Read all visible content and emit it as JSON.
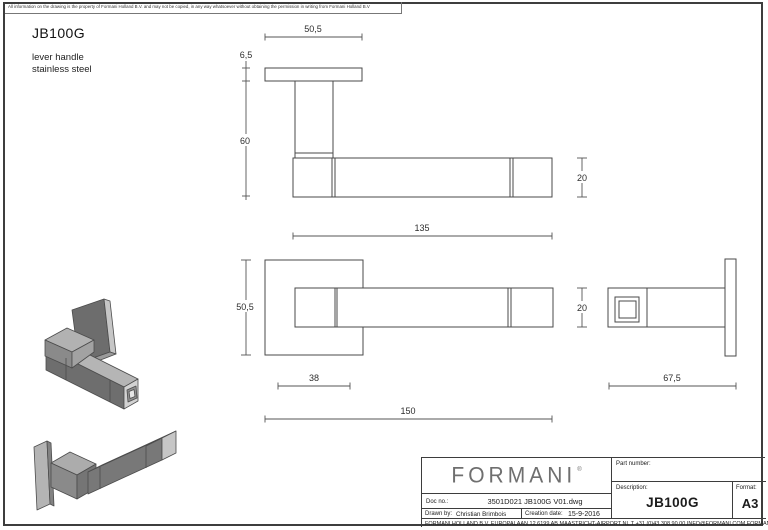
{
  "page": {
    "disclaimer": "All information on the drawing is the property of Formani Holland B.V. and may not be copied, in any way whatsoever without obtaining the permission in writing from Formani Holland B.V",
    "product_code": "JB100G",
    "product_line1": "lever handle",
    "product_line2": "stainless steel"
  },
  "dims": {
    "top_plate_width": "50,5",
    "top_plate_thickness": "6,5",
    "top_neck_length": "60",
    "top_bar_height": "20",
    "top_bar_length": "135",
    "front_rose_size": "50,5",
    "front_bar_height": "20",
    "front_offset": "38",
    "front_total_length": "150",
    "side_depth": "67,5"
  },
  "title_block": {
    "logo_text": "FORMANI",
    "logo_reg": "®",
    "part_number_label": "Part number:",
    "description_label": "Description:",
    "description_value": "JB100G",
    "format_label": "Format:",
    "format_value": "A3",
    "doc_no_label": "Doc no.:",
    "doc_no_value": "3501D021 JB100G V01.dwg",
    "drawn_by_label": "Drawn by:",
    "drawn_by_value": "Christian Brimbois",
    "creation_date_label": "Creation date:",
    "creation_date_value": "15-9-2016",
    "footer": "FORMANI HOLLAND B.V.  EUROPALAAN 12  6199 AB MAASTRICHT-AIRPORT NL  T +31 (0)43 308 90 00 INFO@FORMANI.COM FORMANI.COM"
  },
  "colors": {
    "line": "#4a4a4a",
    "dim_line": "#555555",
    "render_light": "#bdbdbd",
    "render_mid": "#8d8d8d",
    "render_dark": "#6e6e6e"
  }
}
